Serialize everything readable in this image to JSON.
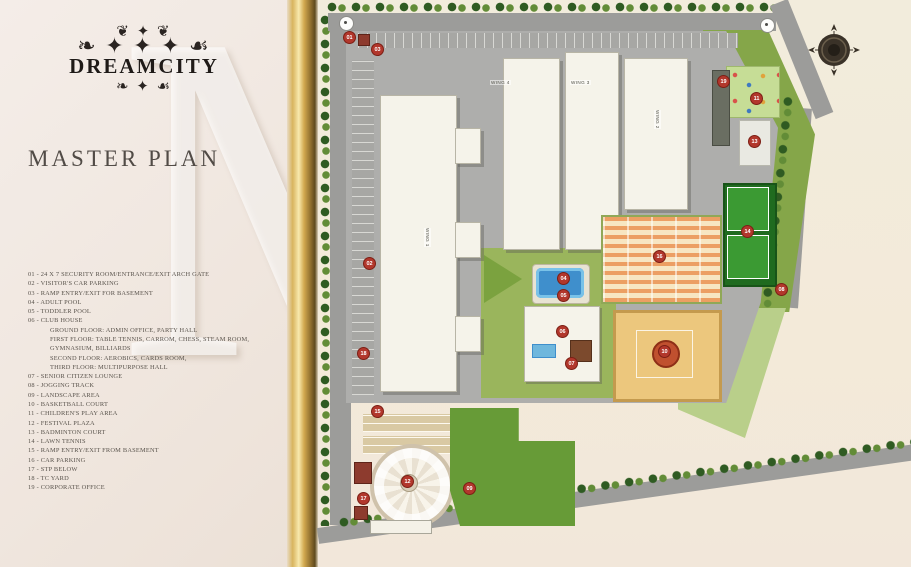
{
  "panel": {
    "logo": {
      "ornament_top": "❦ ✦ ❦",
      "ornament_mid": "❧ ✦ ✦ ✦ ☙",
      "brand": "DREAMCITY",
      "ornament_bottom": "❧ ✦ ☙"
    },
    "title": "MASTER PLAN",
    "watermark": "M",
    "legend": [
      {
        "no": "01",
        "label": "24 X 7 SECURITY ROOM/ENTRANCE/EXIT ARCH GATE"
      },
      {
        "no": "02",
        "label": "VISITOR'S CAR PARKING"
      },
      {
        "no": "03",
        "label": "RAMP ENTRY/EXIT FOR BASEMENT"
      },
      {
        "no": "04",
        "label": "ADULT POOL"
      },
      {
        "no": "05",
        "label": "TODDLER POOL"
      },
      {
        "no": "06",
        "label": "CLUB HOUSE",
        "sub": [
          "GROUND FLOOR: ADMIN OFFICE, PARTY HALL",
          "FIRST FLOOR: TABLE TENNIS, CARROM, CHESS, STEAM ROOM,",
          "GYMNASIUM, BILLIARDS",
          "SECOND FLOOR: AEROBICS, CARDS ROOM,",
          "THIRD FLOOR: MULTIPURPOSE HALL"
        ]
      },
      {
        "no": "07",
        "label": "SENIOR CITIZEN LOUNGE"
      },
      {
        "no": "08",
        "label": "JOGGING TRACK"
      },
      {
        "no": "09",
        "label": "LANDSCAPE AREA"
      },
      {
        "no": "10",
        "label": "BASKETBALL COURT"
      },
      {
        "no": "11",
        "label": "CHILDREN'S PLAY AREA"
      },
      {
        "no": "12",
        "label": "FESTIVAL PLAZA"
      },
      {
        "no": "13",
        "label": "BADMINTON COURT"
      },
      {
        "no": "14",
        "label": "LAWN TENNIS"
      },
      {
        "no": "15",
        "label": "RAMP ENTRY/EXIT FROM BASEMENT"
      },
      {
        "no": "16",
        "label": "CAR PARKING"
      },
      {
        "no": "17",
        "label": "STP BELOW"
      },
      {
        "no": "18",
        "label": "TC YARD"
      },
      {
        "no": "19",
        "label": "CORPORATE OFFICE"
      }
    ]
  },
  "map": {
    "wing_labels": [
      {
        "text": "WING 4",
        "x": 172,
        "y": 80,
        "vert": false
      },
      {
        "text": "WING 3",
        "x": 252,
        "y": 80,
        "vert": false
      },
      {
        "text": "WING 1",
        "x": 106,
        "y": 228,
        "vert": true
      },
      {
        "text": "WING 2",
        "x": 336,
        "y": 110,
        "vert": true
      }
    ],
    "markers": [
      {
        "n": "01",
        "x": 30,
        "y": 36
      },
      {
        "n": "03",
        "x": 58,
        "y": 48
      },
      {
        "n": "02",
        "x": 50,
        "y": 262
      },
      {
        "n": "18",
        "x": 44,
        "y": 352
      },
      {
        "n": "15",
        "x": 58,
        "y": 410
      },
      {
        "n": "04",
        "x": 244,
        "y": 277
      },
      {
        "n": "05",
        "x": 244,
        "y": 294
      },
      {
        "n": "06",
        "x": 243,
        "y": 330
      },
      {
        "n": "07",
        "x": 252,
        "y": 362
      },
      {
        "n": "16",
        "x": 340,
        "y": 255
      },
      {
        "n": "10",
        "x": 345,
        "y": 350
      },
      {
        "n": "14",
        "x": 428,
        "y": 230
      },
      {
        "n": "19",
        "x": 404,
        "y": 80
      },
      {
        "n": "11",
        "x": 437,
        "y": 97
      },
      {
        "n": "13",
        "x": 435,
        "y": 140
      },
      {
        "n": "08",
        "x": 462,
        "y": 288
      },
      {
        "n": "12",
        "x": 88,
        "y": 480
      },
      {
        "n": "09",
        "x": 150,
        "y": 487
      },
      {
        "n": "17",
        "x": 44,
        "y": 497
      }
    ],
    "colors": {
      "road": "#9c9c9a",
      "podium": "#aeaeac",
      "building": "#f5f3ea",
      "grass": "#85a649",
      "lawn": "#679b37",
      "pool_water": "#3f8fcc",
      "tennis_court": "#3b9a33",
      "basketball_court": "#ecc77d",
      "parking_canopy_stripe": "#ec9f63",
      "marker": "#b2372c",
      "gold_spine": "#d2a94f"
    }
  }
}
